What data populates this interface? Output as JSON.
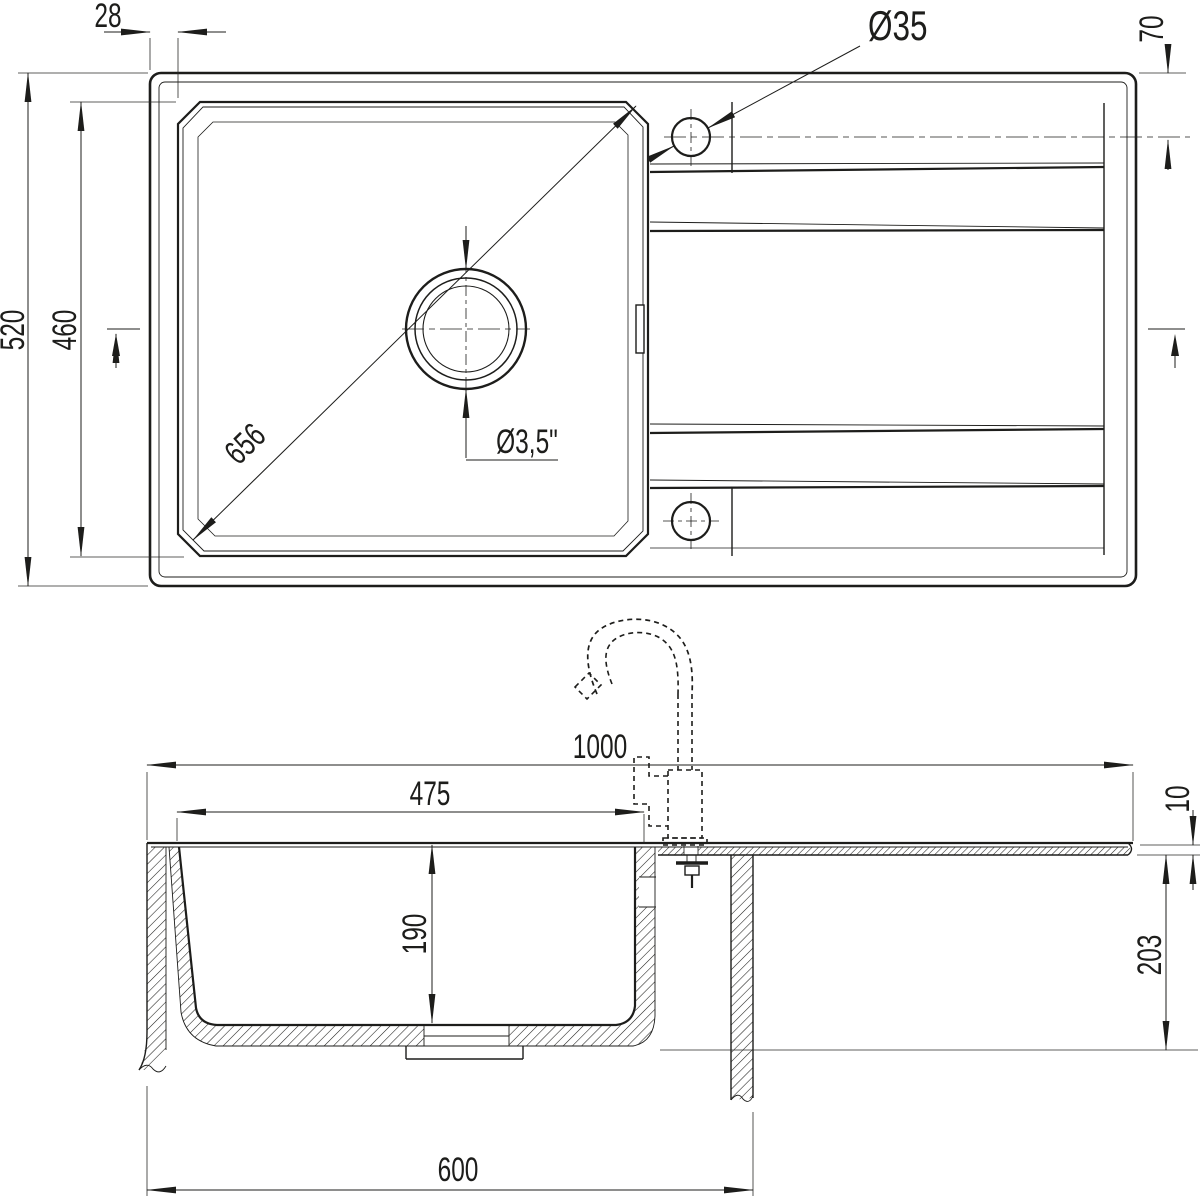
{
  "document": {
    "type": "technical-dimension-drawing",
    "subject": "kitchen sink with single bowl and drainboard",
    "views": {
      "top": "plan view",
      "bottom": "front section view with faucet"
    }
  },
  "dims": {
    "rim_to_bowl": "28",
    "tap_hole_dia": "Ø35",
    "tap_hole_offset": "70",
    "overall_width": "520",
    "bowl_width_plan": "460",
    "bowl_diagonal": "656",
    "drain_dia": "Ø3,5\"",
    "overall_length": "1000",
    "bowl_to_tap_axis": "475",
    "bowl_depth": "190",
    "board_thickness": "10",
    "under_depth": "203",
    "cabinet_width": "600"
  }
}
